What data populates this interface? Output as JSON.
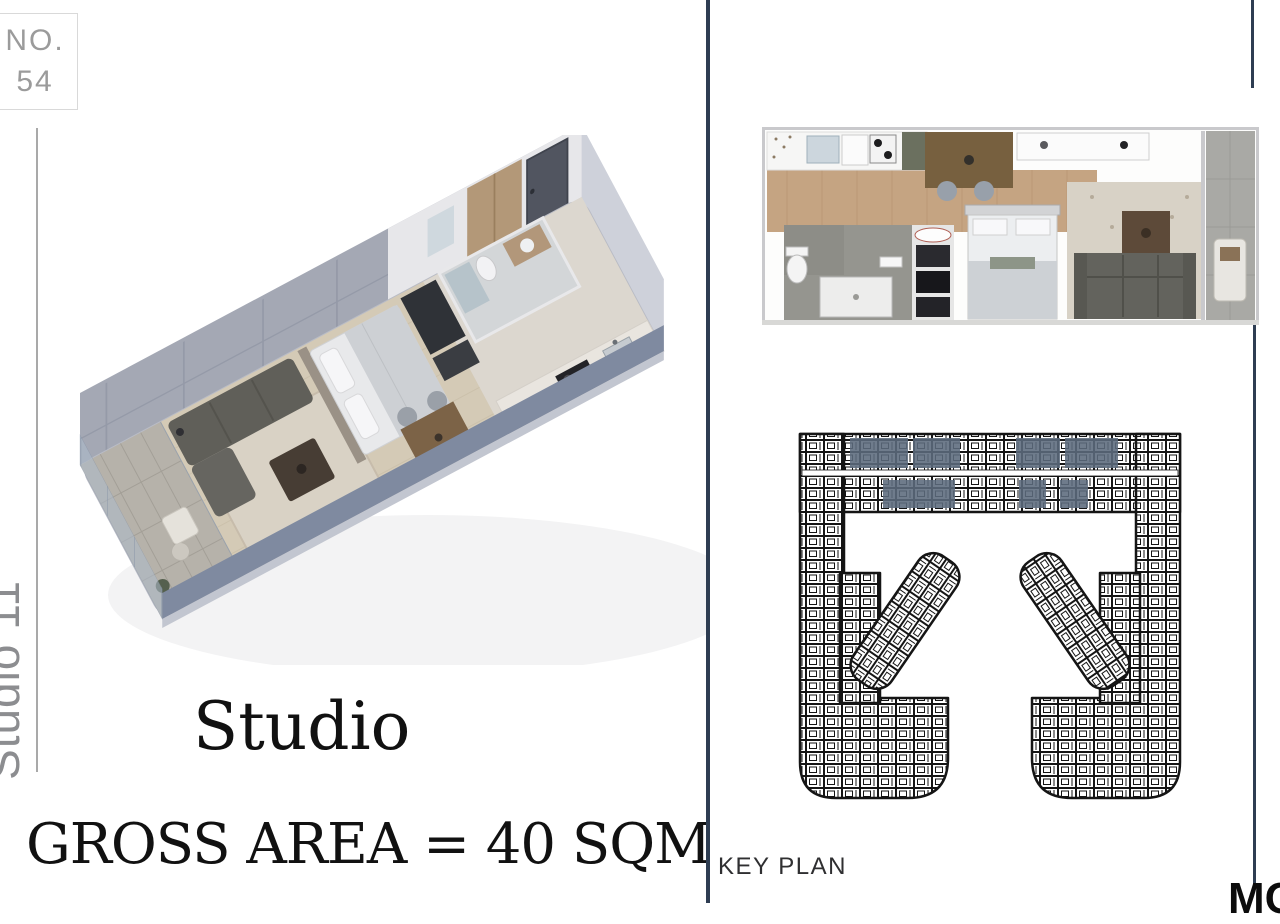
{
  "badge": {
    "label": "NO.",
    "number": "54"
  },
  "side_label": {
    "text": "Studio 11"
  },
  "unit": {
    "name": "Studio",
    "gross_area": "GROSS AREA = 40 SQM"
  },
  "key_plan": {
    "label": "KEY PLAN"
  },
  "logo": {
    "text": "MC"
  },
  "colors": {
    "divider_navy": "#2e3d52",
    "keyplan_highlight": "#5c6b7d",
    "keyplan_ink": "#151515",
    "muted_text": "#9b9b9b"
  }
}
